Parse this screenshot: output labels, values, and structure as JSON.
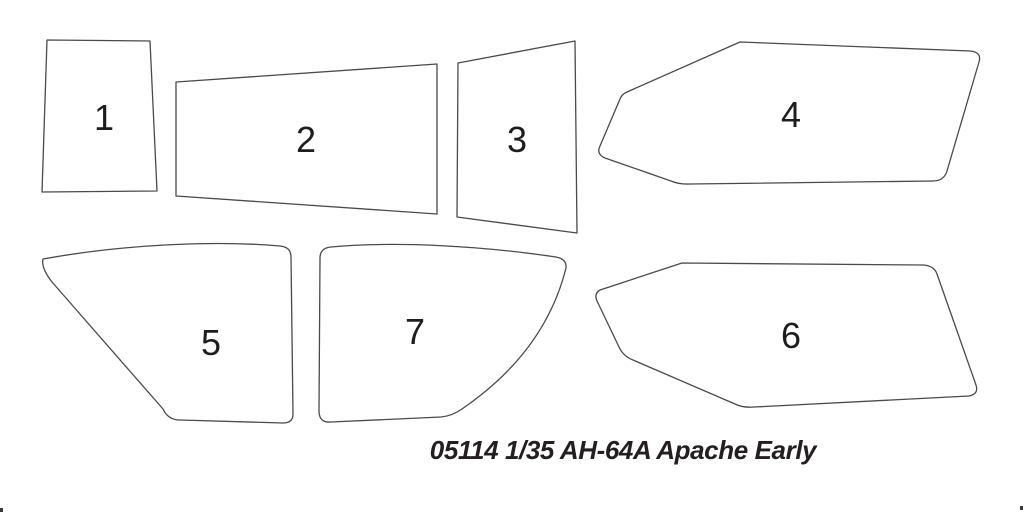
{
  "page": {
    "caption": "05114 1/35 AH-64A Apache Early"
  },
  "colors": {
    "background": "#ffffff",
    "outline": "#4a4a4a",
    "label": "#1d1d1d",
    "caption": "#231f20"
  },
  "parts": [
    {
      "number": "1"
    },
    {
      "number": "2"
    },
    {
      "number": "3"
    },
    {
      "number": "4"
    },
    {
      "number": "5"
    },
    {
      "number": "6"
    },
    {
      "number": "7"
    }
  ]
}
